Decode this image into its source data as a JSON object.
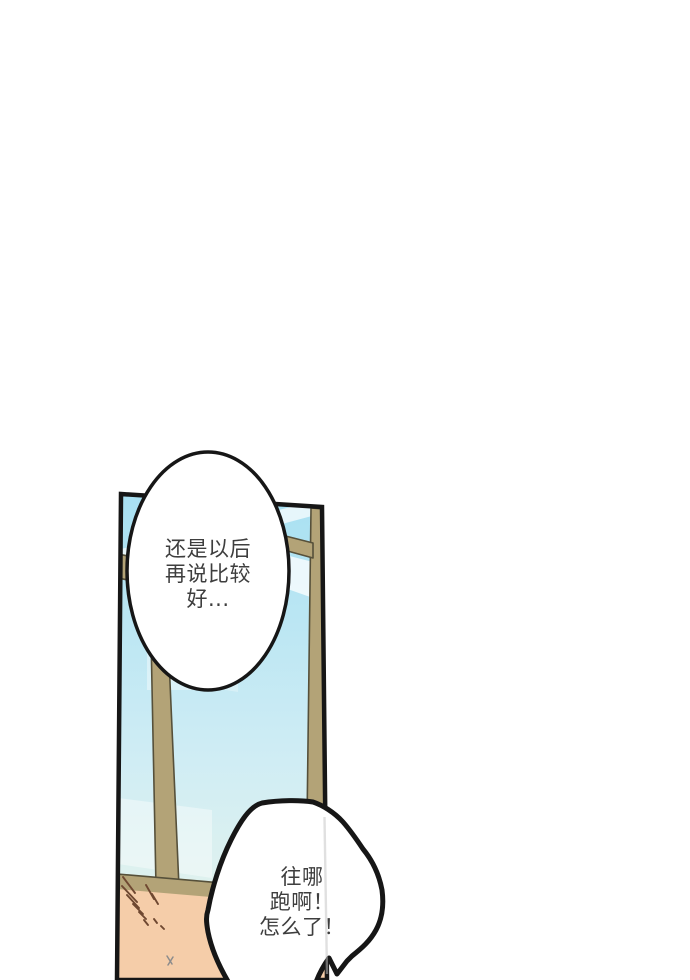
{
  "bubbles": {
    "top": {
      "lines": [
        "还是以后",
        "再说比较",
        "好..."
      ]
    },
    "bottom": {
      "lines": [
        "往哪",
        "跑啊！",
        "怎么了！"
      ]
    }
  },
  "art": {
    "colors": {
      "page_background": "#ffffff",
      "outline": "#161616",
      "sky_top": "#a8e0f2",
      "sky_mid": "#d0edf4",
      "sky_bottom": "#eaf5ea",
      "cloud": "#ffffff",
      "window_frame": "#b3a377",
      "frame_edge": "#56503a",
      "skin": "#f5cda9",
      "hair_stroke": "#6f4831",
      "small_mark": "#8c8c8c",
      "ghost_line": "#c2c2c2",
      "bubble_fill": "#ffffff",
      "text": "#3e3e3e"
    }
  }
}
